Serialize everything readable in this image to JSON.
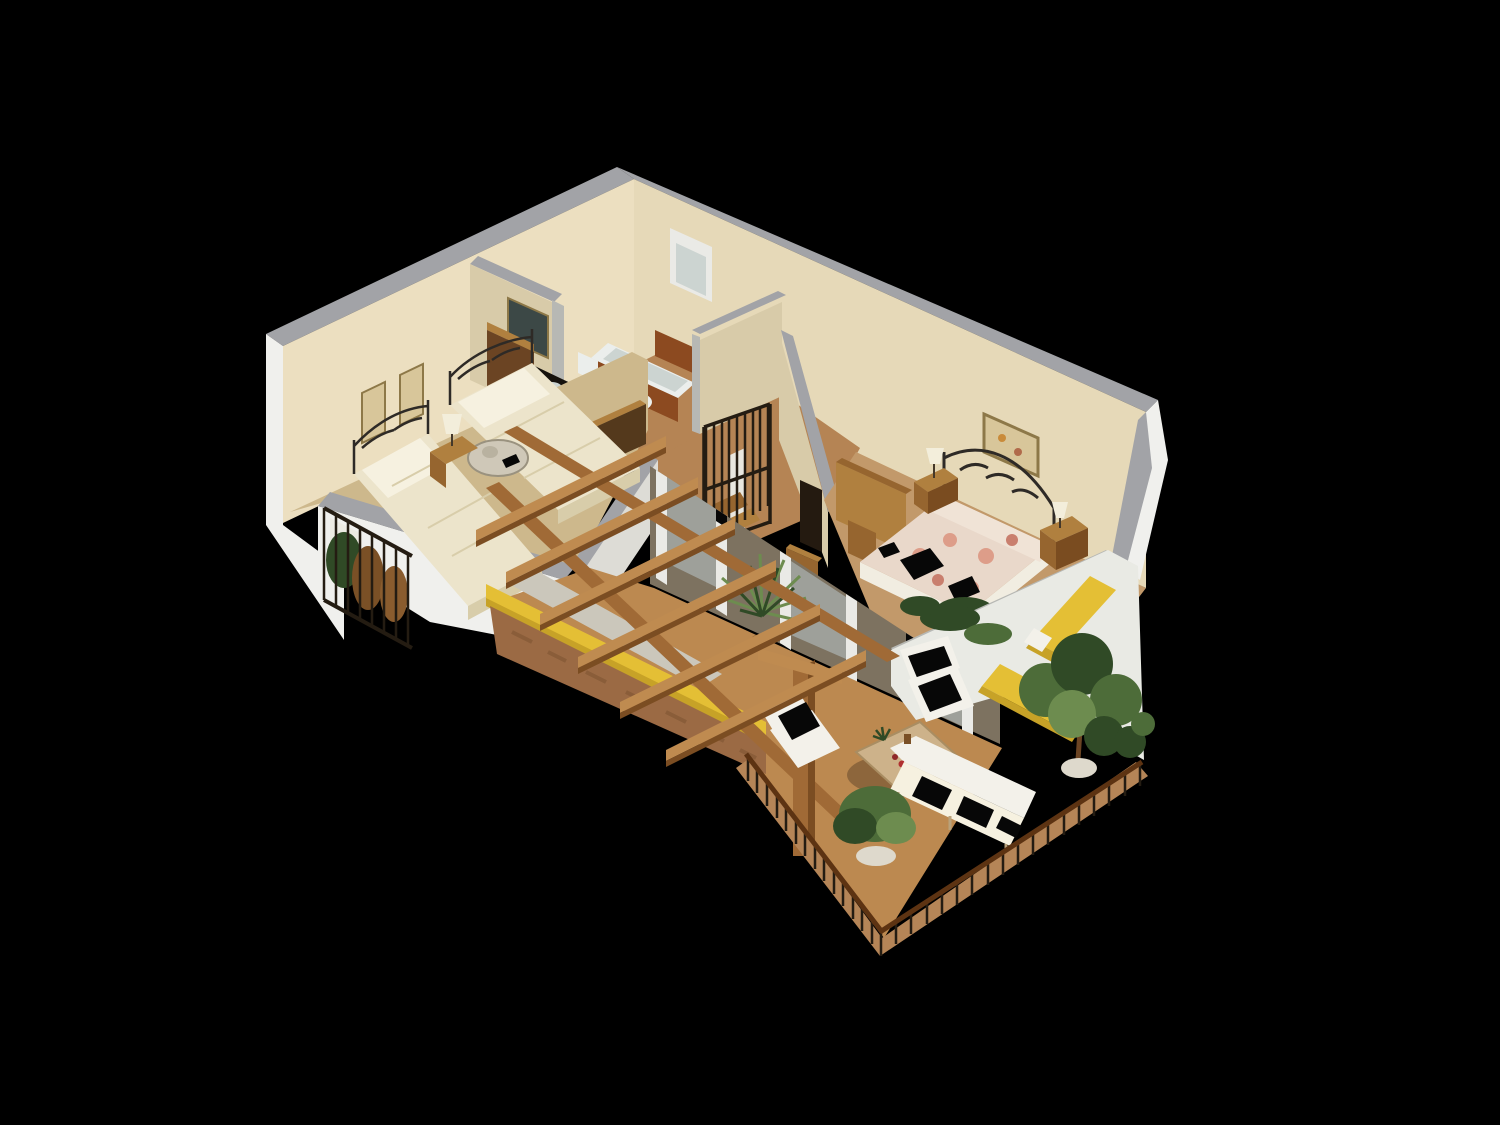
{
  "scene": {
    "type": "3d-isometric-floorplan-render",
    "background": "#000000",
    "description": "Isometric 3D cutaway render of an apartment floor plan on a black background: twin bedroom, bathroom, hallway with spiral staircase, master bedroom, pergola-covered terrace with outdoor furniture, brick parapet with yellow cap, iron railings and potted plants",
    "rooms": [
      {
        "name": "twin-bedroom",
        "contents": [
          "single-bed",
          "single-bed",
          "iron-headboards",
          "nightstand",
          "table-lamp",
          "wall-picture",
          "wall-picture",
          "wardrobe",
          "breakfast-tray",
          "side-balcony-with-plants"
        ]
      },
      {
        "name": "bathroom",
        "contents": [
          "bathtub",
          "toilet",
          "bidet",
          "vanity-counter-sink",
          "mirror",
          "window",
          "wood-wainscot"
        ]
      },
      {
        "name": "hallway",
        "contents": [
          "spiral-staircase",
          "stair-enclosure-box",
          "doorway",
          "wooden-chest"
        ]
      },
      {
        "name": "master-bedroom",
        "contents": [
          "double-bed-floral-spread",
          "iron-headboard",
          "nightstand",
          "nightstand",
          "table-lamp",
          "table-lamp",
          "wall-art",
          "wood-partition",
          "shrub-planter"
        ]
      },
      {
        "name": "terrace",
        "contents": [
          "pergola-beams",
          "pergola-rails",
          "pergola-post",
          "brick-parapet-yellow-cap",
          "concrete-walkway",
          "sliding-glass-doors",
          "yucca-plant",
          "armchair",
          "side-chair",
          "coffee-table",
          "outdoor-sofa",
          "round-potted-plant",
          "wood-deck-edge",
          "iron-railing"
        ]
      },
      {
        "name": "side-terrace",
        "contents": [
          "white-deck",
          "sun-lounger",
          "sun-lounger",
          "large-potted-tree",
          "potted-plant",
          "iron-railing"
        ]
      }
    ]
  },
  "colors": {
    "bg": "#000000",
    "wallTop": "#a2a3a7",
    "grayBand": "#b7b8b4",
    "beigeNW": "#ecdfc0",
    "beigeNE": "#e6d9b8",
    "beigeDim": "#d8cba9",
    "white": "#f0f0ed",
    "whiteDim": "#dddcd6",
    "deckWhite": "#e9eae4",
    "floorBedroom": "#cdb88c",
    "floorWood": "#b58454",
    "floorMaster": "#c2996a",
    "floorTerrace": "#bc8950",
    "walkway": "#cbc7bb",
    "yellow": "#e4bf35",
    "yellowDim": "#c7a227",
    "brick": "#9b6a44",
    "brickDark": "#7c5231",
    "beam": "#a06a36",
    "beamLight": "#bf8b50",
    "beamDark": "#7b4d22",
    "railWoodLight": "#b58557",
    "railHand": "#5d3312",
    "iron": "#241c12",
    "ironGray": "#2e2a26",
    "linen": "#ece4cb",
    "linenDim": "#d8cdaa",
    "pillow": "#f6f1e0",
    "floral": "#e9d8ca",
    "floralPink": "#dd9d89",
    "sheet": "#f0e3d6",
    "skirt": "#f1ede1",
    "furnWhite": "#f3f1ea",
    "glitch": "#070707",
    "woodFurn": "#96652f",
    "woodFurnLight": "#b0803f",
    "woodDark": "#6b4423",
    "plant": "#4d6c39",
    "plantDark": "#304a26",
    "plantLight": "#6d8c4f",
    "porcelain": "#ebeeec",
    "porcelainDim": "#ccd4d1",
    "wainscot": "#8c4a20",
    "counter": "#16120d",
    "mirror": "#3c4846",
    "art": "#d8c69a",
    "artFrame": "#8d7848",
    "lamp": "#f3eedb",
    "glassFrame": "#eaeae6",
    "glass": "#b9c7ca",
    "interiorDim": "#7d7260",
    "potWhite": "#ded9cc",
    "shadow": "#000000"
  }
}
